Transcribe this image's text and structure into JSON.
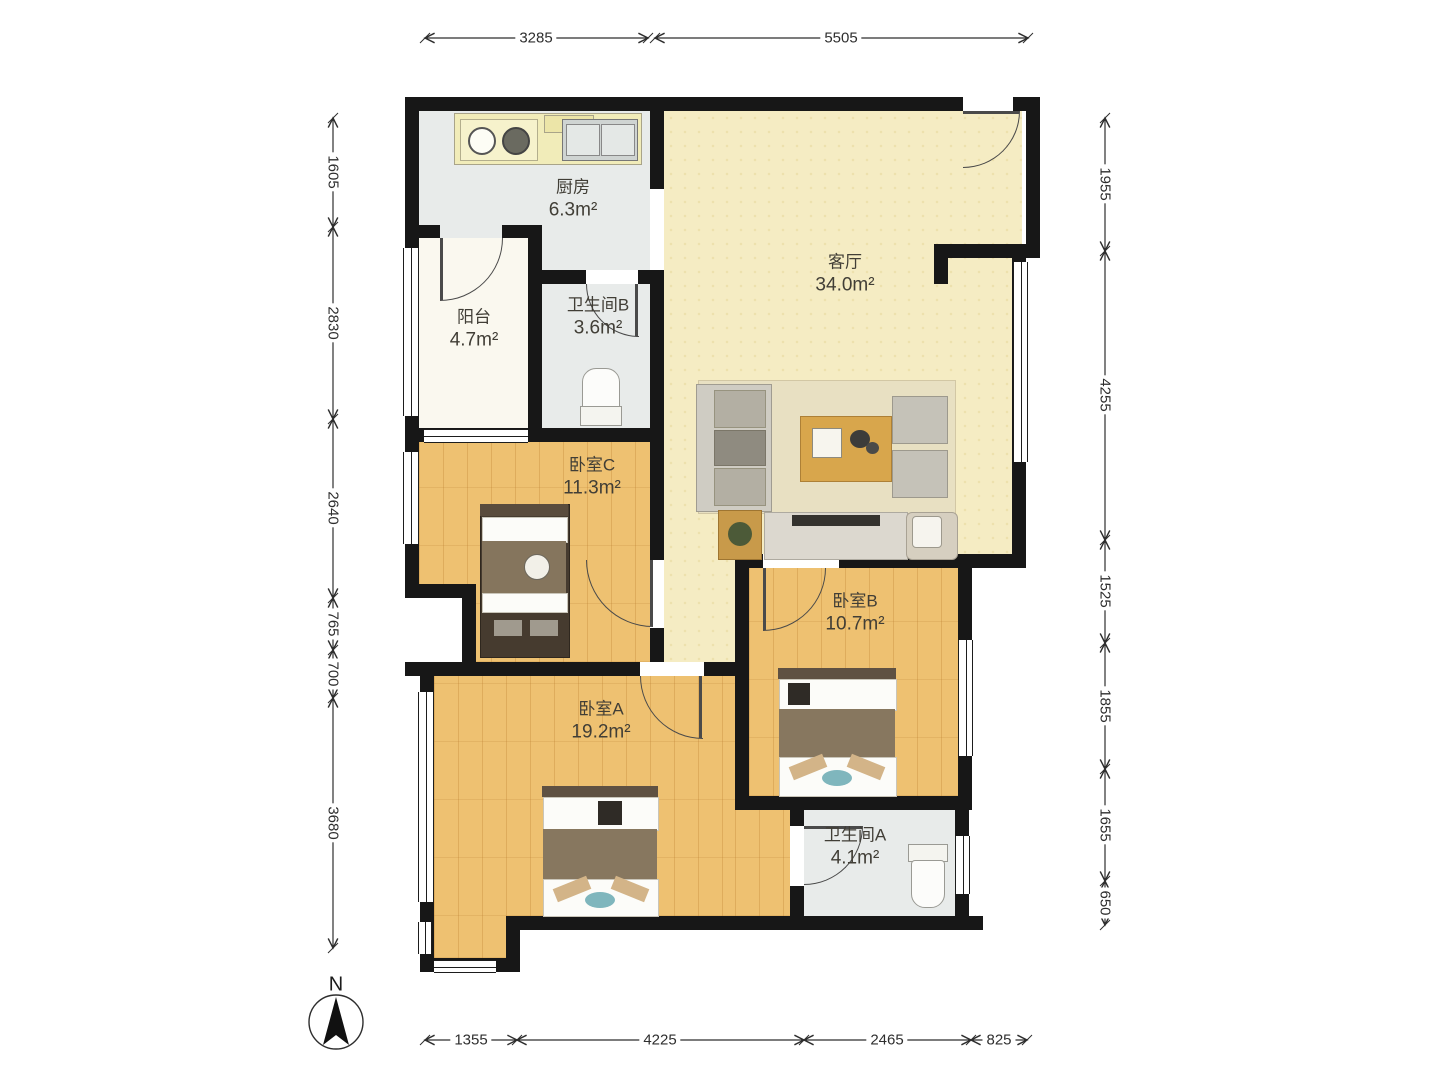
{
  "title": "apartment-floor-plan",
  "compass": {
    "label": "N"
  },
  "rooms": [
    {
      "id": "kitchen",
      "name": "厨房",
      "area": "6.3m²"
    },
    {
      "id": "balcony",
      "name": "阳台",
      "area": "4.7m²"
    },
    {
      "id": "bath_b",
      "name": "卫生间B",
      "area": "3.6m²"
    },
    {
      "id": "living",
      "name": "客厅",
      "area": "34.0m²"
    },
    {
      "id": "bed_c",
      "name": "卧室C",
      "area": "11.3m²"
    },
    {
      "id": "bed_b",
      "name": "卧室B",
      "area": "10.7m²"
    },
    {
      "id": "bed_a",
      "name": "卧室A",
      "area": "19.2m²"
    },
    {
      "id": "bath_a",
      "name": "卫生间A",
      "area": "4.1m²"
    }
  ],
  "dimensions": {
    "top": [
      {
        "label": "3285"
      },
      {
        "label": "5505"
      }
    ],
    "left": [
      {
        "label": "1605"
      },
      {
        "label": "2830"
      },
      {
        "label": "2640"
      },
      {
        "label": "765"
      },
      {
        "label": "700"
      },
      {
        "label": "3680"
      }
    ],
    "right": [
      {
        "label": "1955"
      },
      {
        "label": "4255"
      },
      {
        "label": "1525"
      },
      {
        "label": "1855"
      },
      {
        "label": "1655"
      },
      {
        "label": "650"
      }
    ],
    "bottom": [
      {
        "label": "1355"
      },
      {
        "label": "4225"
      },
      {
        "label": "2465"
      },
      {
        "label": "825"
      }
    ]
  },
  "colors": {
    "wall": "#171717",
    "wood_floor": "#eec171",
    "living_floor": "#f5ecc3",
    "wet_floor": "#e8ebea",
    "balcony_floor": "#faf8ef"
  }
}
